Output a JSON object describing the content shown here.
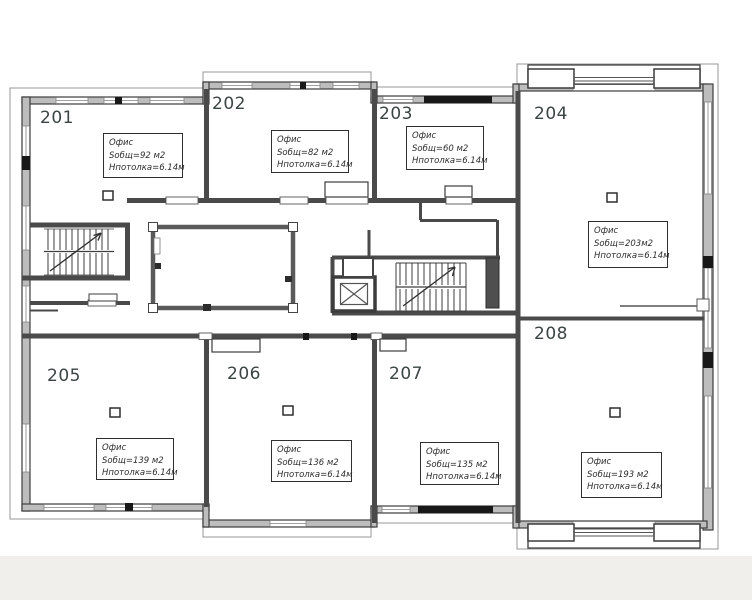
{
  "plan": {
    "rooms": [
      {
        "number": "201",
        "type": "Офис",
        "area": "Sобщ=92 м2",
        "ceiling": "Нпотолка=6.14м"
      },
      {
        "number": "202",
        "type": "Офис",
        "area": "Sобщ=82 м2",
        "ceiling": "Нпотолка=6.14м"
      },
      {
        "number": "203",
        "type": "Офис",
        "area": "Sобщ=60 м2",
        "ceiling": "Нпотолка=6.14м"
      },
      {
        "number": "204",
        "type": "Офис",
        "area": "Sобщ=203м2",
        "ceiling": "Нпотолка=6.14м"
      },
      {
        "number": "205",
        "type": "Офис",
        "area": "Sобщ=139 м2",
        "ceiling": "Нпотолка=6.14м"
      },
      {
        "number": "206",
        "type": "Офис",
        "area": "Sобщ=136 м2",
        "ceiling": "Нпотолка=6.14м"
      },
      {
        "number": "207",
        "type": "Офис",
        "area": "Sобщ=135 м2",
        "ceiling": "Нпотолка=6.14м"
      },
      {
        "number": "208",
        "type": "Офис",
        "area": "Sобщ=193 м2",
        "ceiling": "Нпотолка=6.14м"
      }
    ],
    "elements": {
      "left_staircase": "staircase",
      "center_staircase": "staircase",
      "elevator": "elevator-shaft",
      "atrium": "open-void",
      "balcony_top": "balcony",
      "balcony_bottom": "balcony"
    },
    "colors": {
      "wall": "#4a4a4a",
      "wall_fill": "#bdbdbd",
      "dark_segment": "#181818",
      "outline": "#979797",
      "text": "#3d4444",
      "background": "#ffffff",
      "footer_strip": "#f1efec"
    }
  }
}
